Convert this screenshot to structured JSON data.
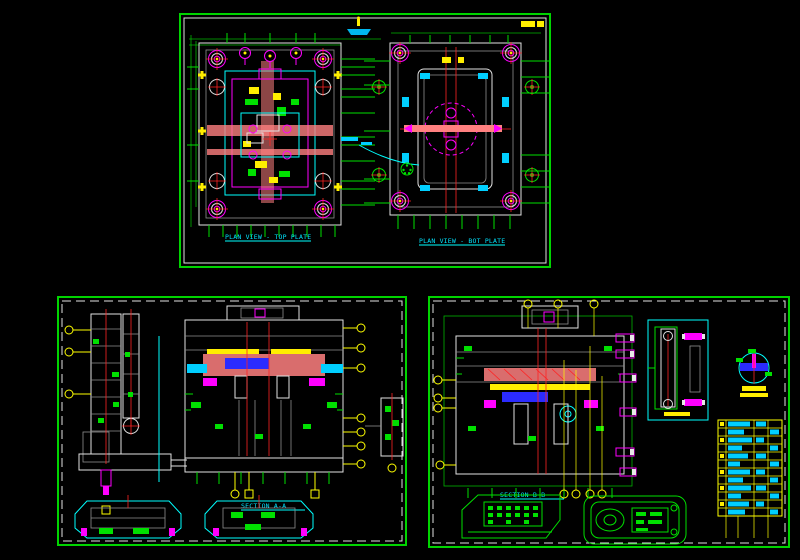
{
  "canvas": {
    "background": "#000000"
  },
  "palette": {
    "border_green": "#00d400",
    "line_green": "#00e000",
    "cyan": "#00ffff",
    "magenta": "#ff00ff",
    "yellow": "#ffee00",
    "red": "#ff2222",
    "white": "#e8e8e8",
    "pink": "#ff8080",
    "blue": "#2b2bff"
  },
  "sheet_top": {
    "caption_left": "PLAN VIEW - TOP PLATE",
    "caption_right": "PLAN VIEW - BOT PLATE"
  },
  "sheet_bottom_left": {
    "caption_section": "SECTION A-A"
  },
  "sheet_bottom_right": {
    "caption_section": "SECTION B-B"
  }
}
